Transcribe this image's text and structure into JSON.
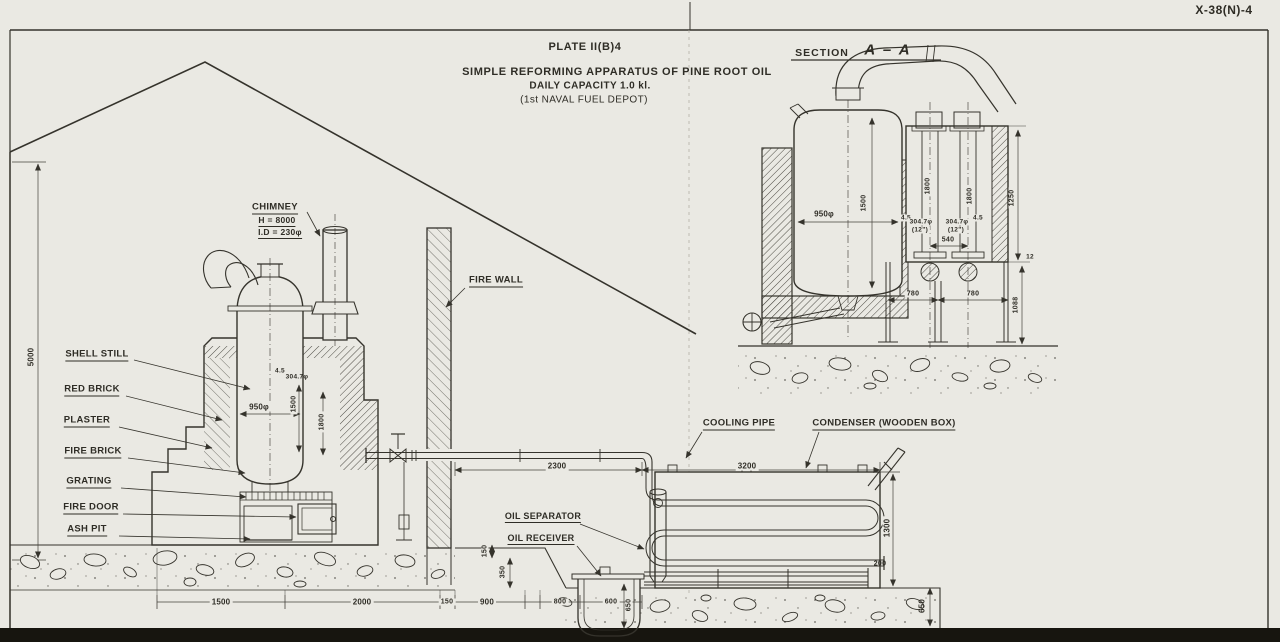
{
  "sheet": {
    "ref": "X-38(N)-4"
  },
  "title": {
    "plate": "PLATE II(B)4",
    "name": "SIMPLE REFORMING APPARATUS OF PINE ROOT OIL",
    "capacity": "DAILY CAPACITY 1.0 kl.",
    "depot": "(1st NAVAL FUEL DEPOT)"
  },
  "section": {
    "heading": "SECTION",
    "letters": "A – A",
    "dims": {
      "still_dia": "950φ",
      "still_h": "1500",
      "tube_a": "1800",
      "tube_b": "1800",
      "box_h": "1250",
      "pitch": "540",
      "span_a": "780",
      "span_b": "780",
      "foundation": "1088",
      "thk_a": "4.5",
      "dia_a": "304.7φ",
      "inch_a": "(12\")",
      "thk_b": "4.5",
      "dia_b": "304.7φ",
      "inch_b": "(12\")",
      "plate_thk": "12"
    }
  },
  "labels": {
    "chimney": "CHIMNEY",
    "chimney_h": "H = 8000",
    "chimney_id": "I.D = 230φ",
    "fire_wall": "FIRE WALL",
    "shell_still": "SHELL STILL",
    "red_brick": "RED BRICK",
    "plaster": "PLASTER",
    "fire_brick": "FIRE BRICK",
    "grating": "GRATING",
    "fire_door": "FIRE DOOR",
    "ash_pit": "ASH PIT",
    "cooling_pipe": "COOLING PIPE",
    "condenser": "CONDENSER (WOODEN BOX)",
    "oil_separator": "OIL SEPARATOR",
    "oil_receiver": "OIL RECEIVER"
  },
  "dims": {
    "wall_h": "5000",
    "still_dia": "950φ",
    "still_h": "1500",
    "flue_depth": "1800",
    "pipe_thk": "4.5",
    "pipe_dia": "304.7φ",
    "pipe_run": "2300",
    "cond_len": "3200",
    "cond_h": "1300",
    "outlet": "200",
    "pit_d": "650",
    "recv_up": "150",
    "recv_low": "350",
    "recv_h": "650",
    "base_a": "1500",
    "base_b": "2000",
    "base_c": "150",
    "base_d": "900",
    "base_e": "800",
    "base_f": "600"
  }
}
